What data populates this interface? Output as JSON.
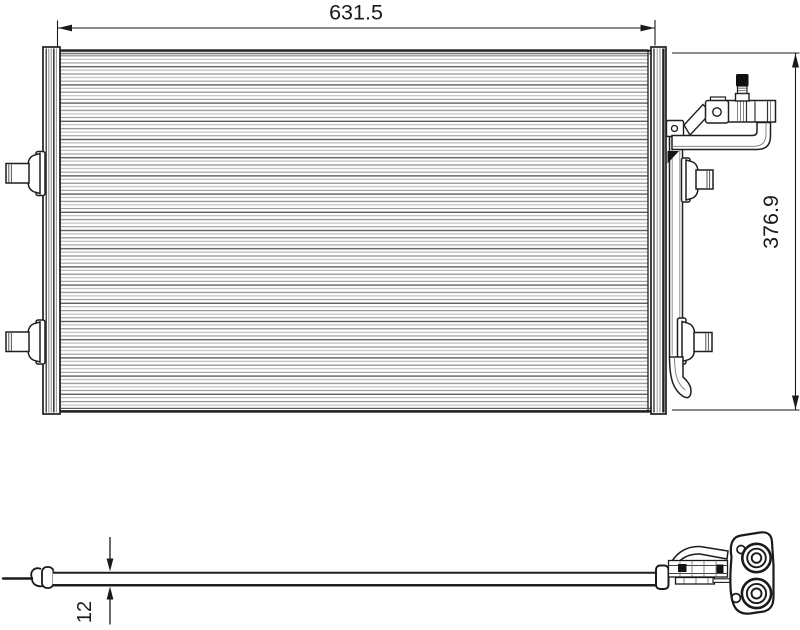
{
  "drawing": {
    "dimensions": {
      "width": "631.5",
      "height": "376.9",
      "depth": "12"
    },
    "colors": {
      "line": "#1a1a1a",
      "fin_line": "#9a9a9a",
      "background": "#ffffff",
      "valve_cap": "#101010"
    }
  }
}
